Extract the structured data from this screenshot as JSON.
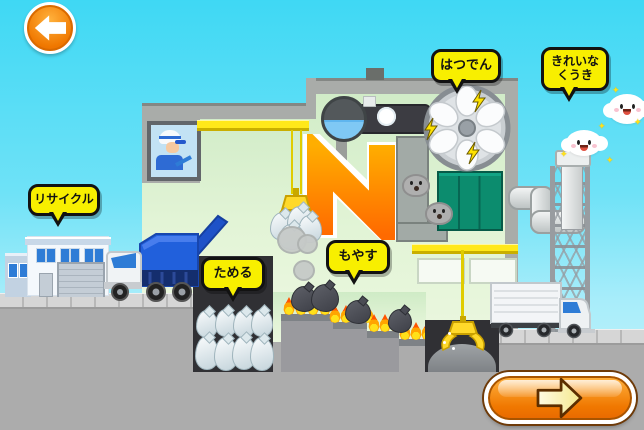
{
  "bubbles": {
    "recycle": "リサイクル",
    "store": "ためる",
    "burn": "もやす",
    "power": "はつでん",
    "clean_air": "きれいな\nくうき"
  },
  "icons": {
    "back": "arrow-left",
    "next": "arrow-right",
    "sparkle": "✦"
  },
  "colors": {
    "accent_orange": "#F08000",
    "bubble_yellow": "#F8EF00",
    "sky_blue": "#3FD8F4",
    "truck_blue": "#2160DC",
    "furnace_orange": "#FF8A00",
    "fire_orange": "#FF5500",
    "filter_green": "#0C8C6E"
  }
}
